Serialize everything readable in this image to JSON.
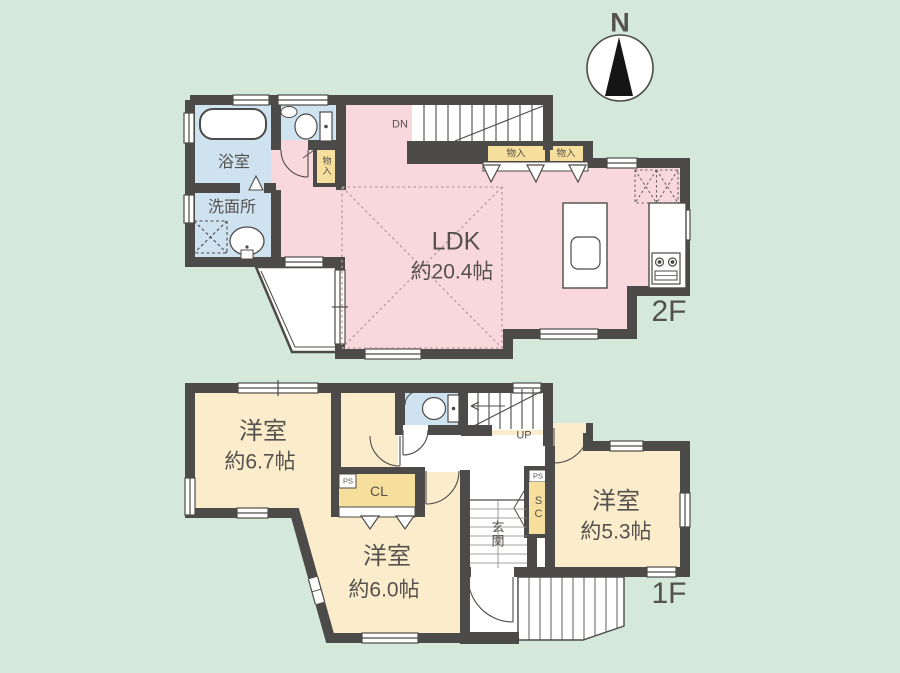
{
  "palette": {
    "background": "#d4e8db",
    "wall": "#4d4b49",
    "ldk_pink": "#f9d8dd",
    "wet_area_blue": "#cee2f0",
    "room_cream": "#fbeccb",
    "storage_yellow": "#f6df9c",
    "text": "#55514e"
  },
  "compass": {
    "label": "N"
  },
  "floor2": {
    "label": "2F",
    "ldk": {
      "name": "LDK",
      "size": "約20.4帖"
    },
    "bath": {
      "name": "浴室"
    },
    "washroom": {
      "name": "洗面所"
    },
    "hall_storage": {
      "name": "物入"
    },
    "storage_left": {
      "name": "物入"
    },
    "storage_right": {
      "name": "物入"
    },
    "stairs": {
      "label": "DN"
    }
  },
  "floor1": {
    "label": "1F",
    "bedroom_nw": {
      "name": "洋室",
      "size": "約6.7帖"
    },
    "bedroom_s": {
      "name": "洋室",
      "size": "約6.0帖"
    },
    "bedroom_e": {
      "name": "洋室",
      "size": "約5.3帖"
    },
    "closet": {
      "label": "CL"
    },
    "shoe_closet": {
      "label": "SC"
    },
    "entrance": {
      "label": "玄関"
    },
    "stairs": {
      "label": "UP"
    },
    "ps_a": {
      "label": "PS"
    },
    "ps_b": {
      "label": "PS"
    }
  },
  "fixtures": [
    "bathtub",
    "toilet",
    "vanity-sink",
    "washing-machine-space",
    "kitchen-island-sink",
    "gas-stove",
    "refrigerator-space",
    "balcony",
    "porch-steps",
    "compass-needle"
  ]
}
